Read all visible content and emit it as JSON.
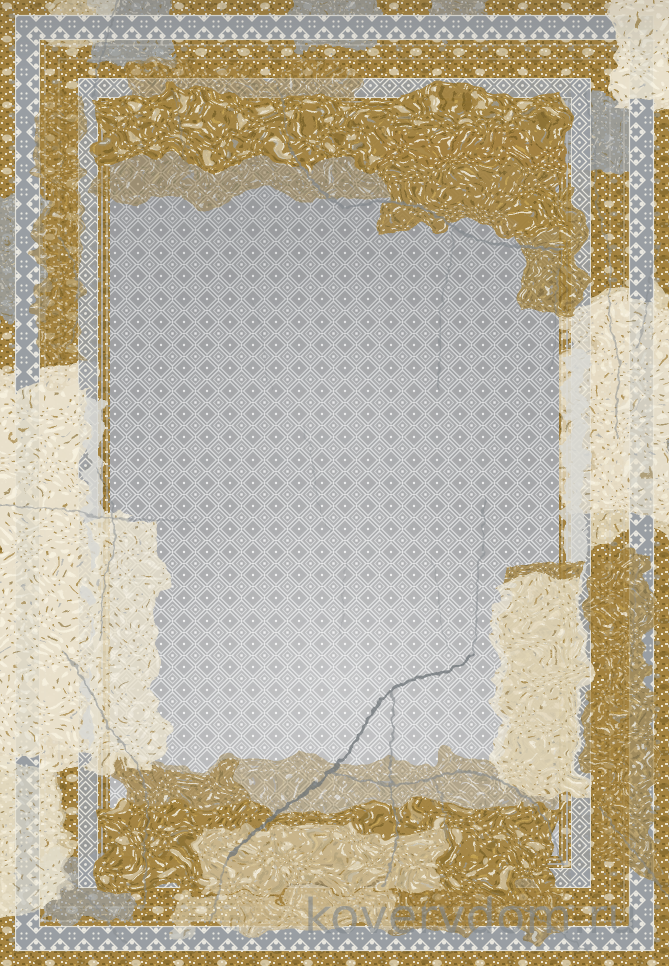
{
  "image": {
    "kind": "product-photo",
    "subject": "Vintage distressed area rug (top view)",
    "description": "Rectangular carpet: ochre-gold speckled distressed border with gray ornamental bands, cracked-plaster gray field covered in a white diamond trellis pattern, dark crack lines across field and borders",
    "watermark": "kovervdom.ru"
  },
  "colors": {
    "gold": "#a3823f",
    "gold_dark": "#7d6429",
    "gold_light": "#c2a050",
    "cream": "#eae2cd",
    "cream_bright": "#f7f1e0",
    "gray_blotch": "#9aa0a5",
    "gray_blotch_light": "#c6c9cc",
    "band_bg": "#999ea3",
    "band_light": "#e9e7df",
    "lattice_bg": "#a1a2a4",
    "lattice_light": "#d9dadb",
    "lattice_bright": "#f1f1f1",
    "lattice_dark": "#8b8d8f",
    "crack": "#82878b",
    "crack_dark": "#6e7377",
    "worn_bar": "#d9d9d5",
    "watermark": "#82888d"
  }
}
